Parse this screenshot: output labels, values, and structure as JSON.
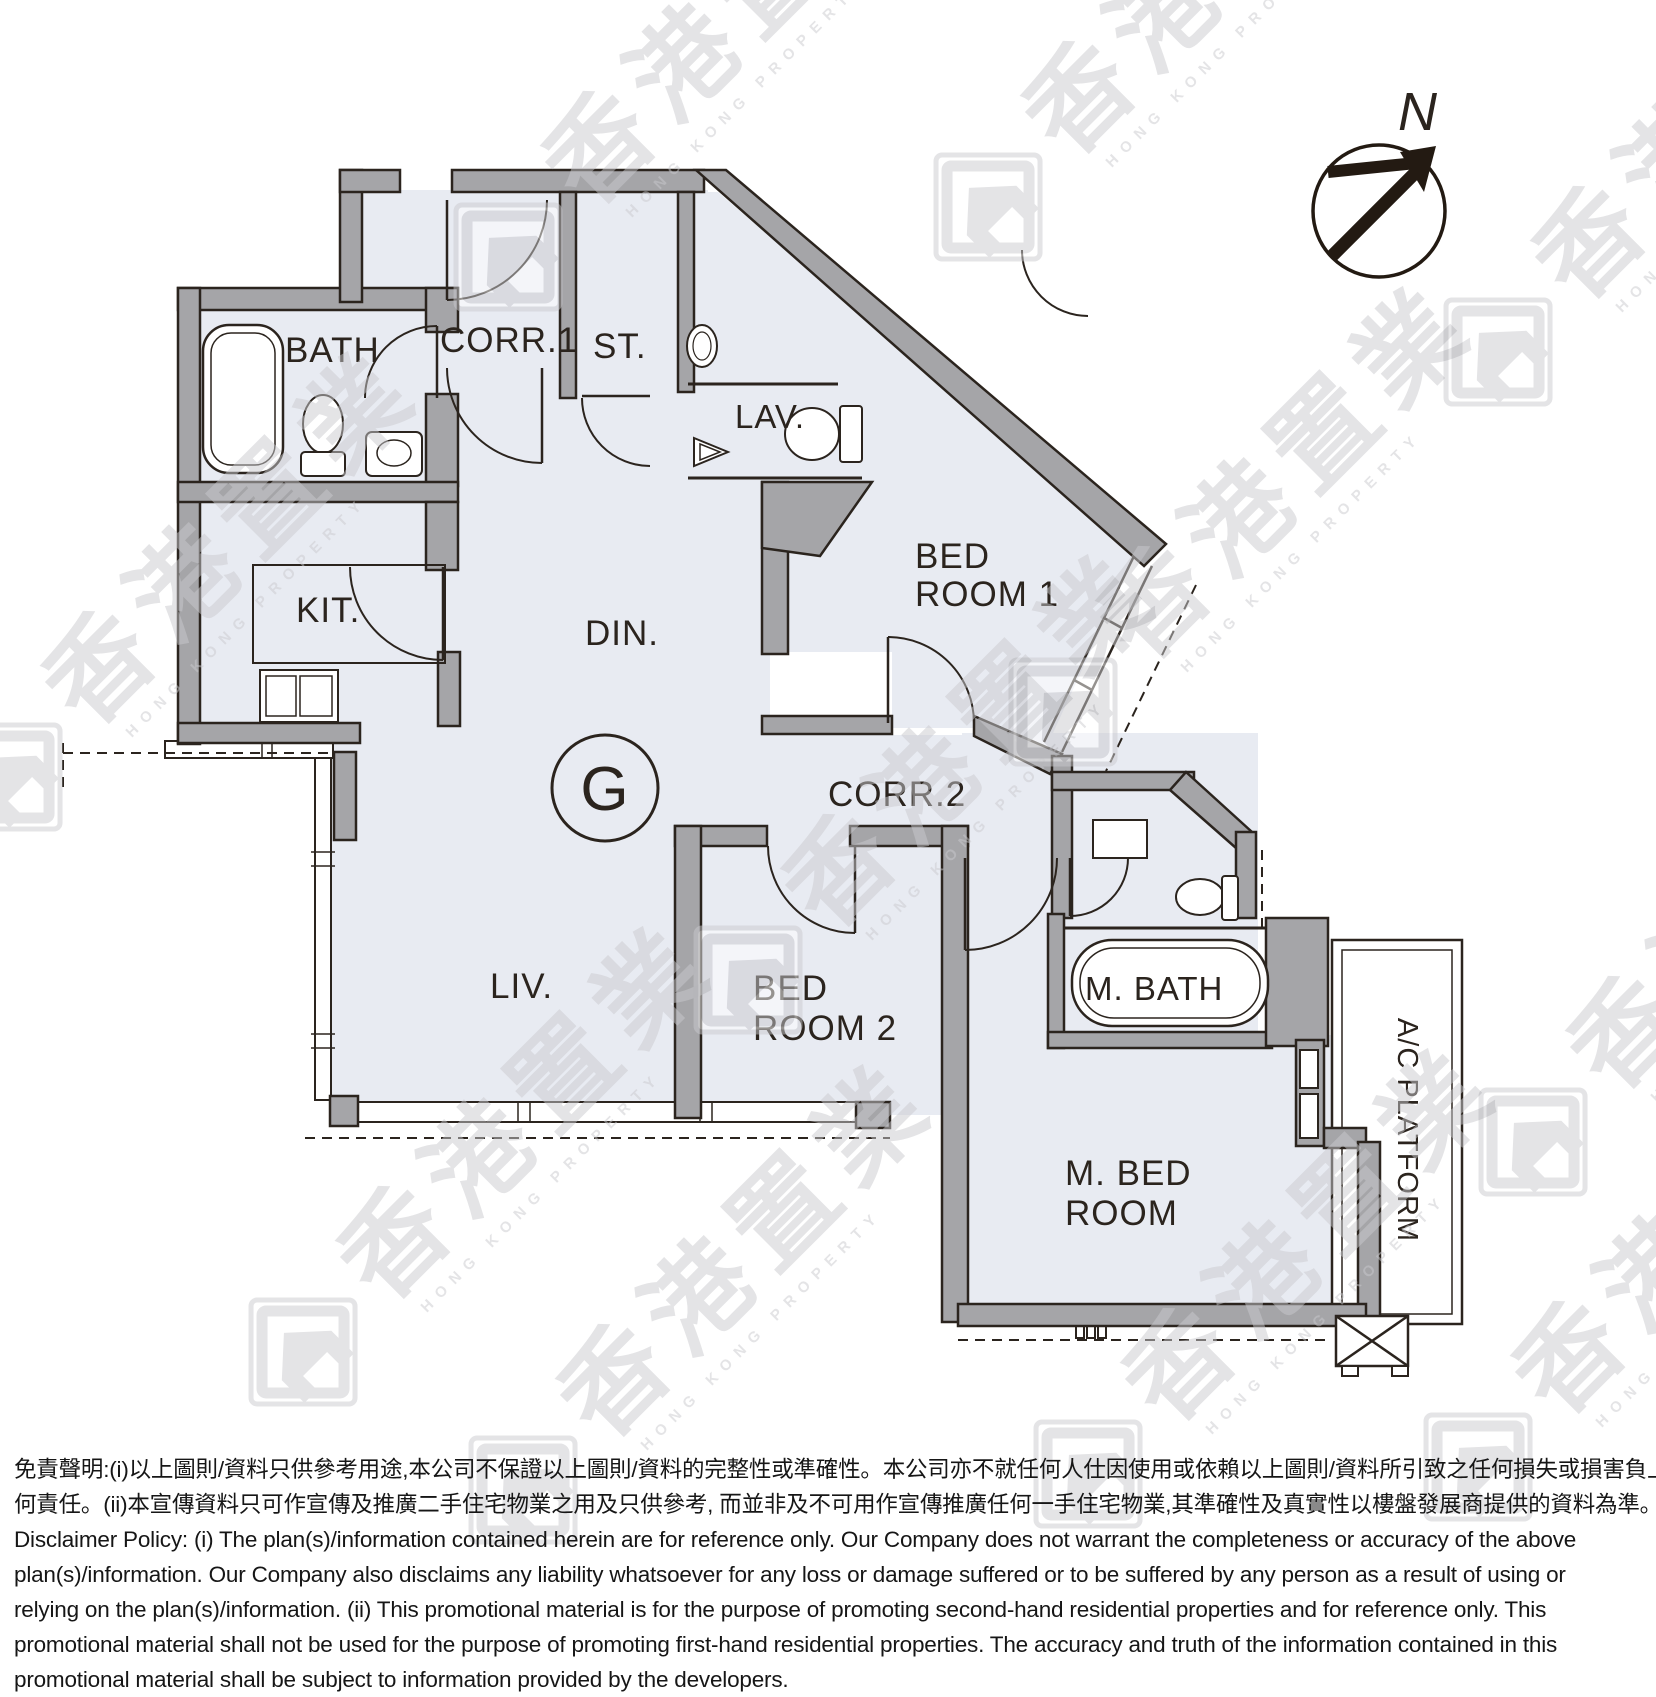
{
  "unit_label": "G",
  "compass": {
    "north_label": "N"
  },
  "rooms": {
    "bath": "BATH",
    "corr1": "CORR.1",
    "st": "ST.",
    "lav": "LAV.",
    "kit": "KIT.",
    "din": "DIN.",
    "bed1_line1": "BED",
    "bed1_line2": "ROOM 1",
    "corr2": "CORR.2",
    "liv": "LIV.",
    "bed2_line1": "BED",
    "bed2_line2": "ROOM 2",
    "mbath": "M. BATH",
    "mbed_line1": "M. BED",
    "mbed_line2": "ROOM",
    "ac_platform": "A/C PLATFORM"
  },
  "watermark": {
    "chinese": "香港置業",
    "english": "HONG KONG PROPERTY",
    "positions": [
      [
        455,
        235
      ],
      [
        935,
        185
      ],
      [
        1445,
        330
      ],
      [
        -45,
        755
      ],
      [
        695,
        958
      ],
      [
        1010,
        690
      ],
      [
        250,
        1330
      ],
      [
        470,
        1468
      ],
      [
        1035,
        1452
      ],
      [
        1480,
        1120
      ],
      [
        1425,
        1445
      ]
    ]
  },
  "disclaimer": {
    "lines": [
      "免責聲明:(i)以上圖則/資料只供參考用途,本公司不保證以上圖則/資料的完整性或準確性。本公司亦不就任何人仕因使用或依賴以上圖則/資料所引致之任何損失或損害負上任",
      "何責任。(ii)本宣傳資料只可作宣傳及推廣二手住宅物業之用及只供參考, 而並非及不可用作宣傳推廣任何一手住宅物業,其準確性及真實性以樓盤發展商提供的資料為準。",
      "Disclaimer Policy: (i) The plan(s)/information contained herein are for reference only. Our Company does not warrant the completeness or accuracy of the above",
      "plan(s)/information. Our Company also disclaims any liability whatsoever for any loss or damage suffered or to be suffered by any person as a result of using or",
      "relying on the plan(s)/information. (ii) This promotional material is for the purpose of promoting second-hand residential properties and for reference only. This",
      "promotional material shall not be used for the purpose of promoting first-hand residential properties. The accuracy and truth of the information contained in this",
      "promotional material shall be subject to information provided by the developers."
    ]
  },
  "colors": {
    "room_fill": "#e8ebf2",
    "wall_gray": "#a5a5a8",
    "line_dark": "#2b241e",
    "watermark_gray": "#c9c9cd"
  }
}
